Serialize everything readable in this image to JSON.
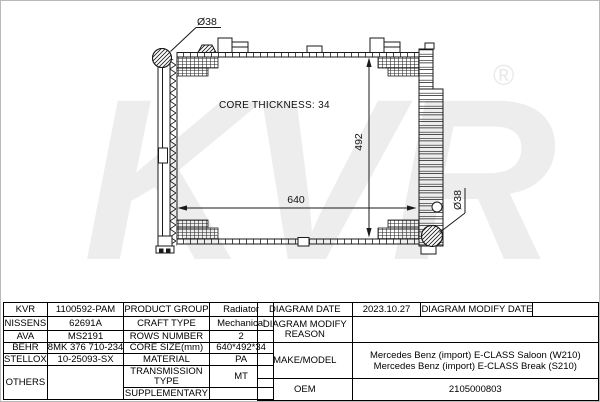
{
  "drawing": {
    "watermark": {
      "text": "KVR",
      "registered_mark": "®"
    },
    "labels": {
      "top_port_diameter": "Ø38",
      "core_thickness": "CORE THICKNESS: 34",
      "core_height": "492",
      "core_width": "640",
      "bottom_port_diameter": "Ø38"
    },
    "colors": {
      "line": "#1a1a1a",
      "watermark": "#ededed"
    }
  },
  "table": {
    "cross_reference_rows": [
      {
        "brand": "KVR",
        "number": "1100592-PAM"
      },
      {
        "brand": "NISSENS",
        "number": "62691A"
      },
      {
        "brand": "AVA",
        "number": "MS2191"
      },
      {
        "brand": "BEHR",
        "number": "8MK 376 710-234"
      },
      {
        "brand": "STELLOX",
        "number": "10-25093-SX"
      },
      {
        "brand": "OTHERS",
        "number": ""
      }
    ],
    "attributes": [
      {
        "label": "PRODUCT GROUP",
        "value": "Radiator"
      },
      {
        "label": "CRAFT TYPE",
        "value": "Mechanical"
      },
      {
        "label": "ROWS NUMBER",
        "value": "2"
      },
      {
        "label": "CORE SIZE(mm)",
        "value": "640*492*34"
      },
      {
        "label": "MATERIAL",
        "value": "PA"
      },
      {
        "label": "TRANSMISSION TYPE",
        "value": "MT"
      },
      {
        "label": "SUPPLEMENTARY",
        "value": ""
      }
    ],
    "info": {
      "diagram_date_label": "DIAGRAM DATE",
      "diagram_date_value": "2023.10.27",
      "diagram_modify_date_label": "DIAGRAM MODIFY DATE",
      "diagram_modify_date_value": "",
      "diagram_modify_reason_label": "DIAGRAM MODIFY REASON",
      "diagram_modify_reason_value": "",
      "make_model_label": "MAKE/MODEL",
      "make_model_line1": "Mercedes Benz (import) E-CLASS Saloon (W210)",
      "make_model_line2": "Mercedes Benz (import) E-CLASS Break (S210)",
      "oem_label": "OEM",
      "oem_value": "2105000803"
    }
  }
}
